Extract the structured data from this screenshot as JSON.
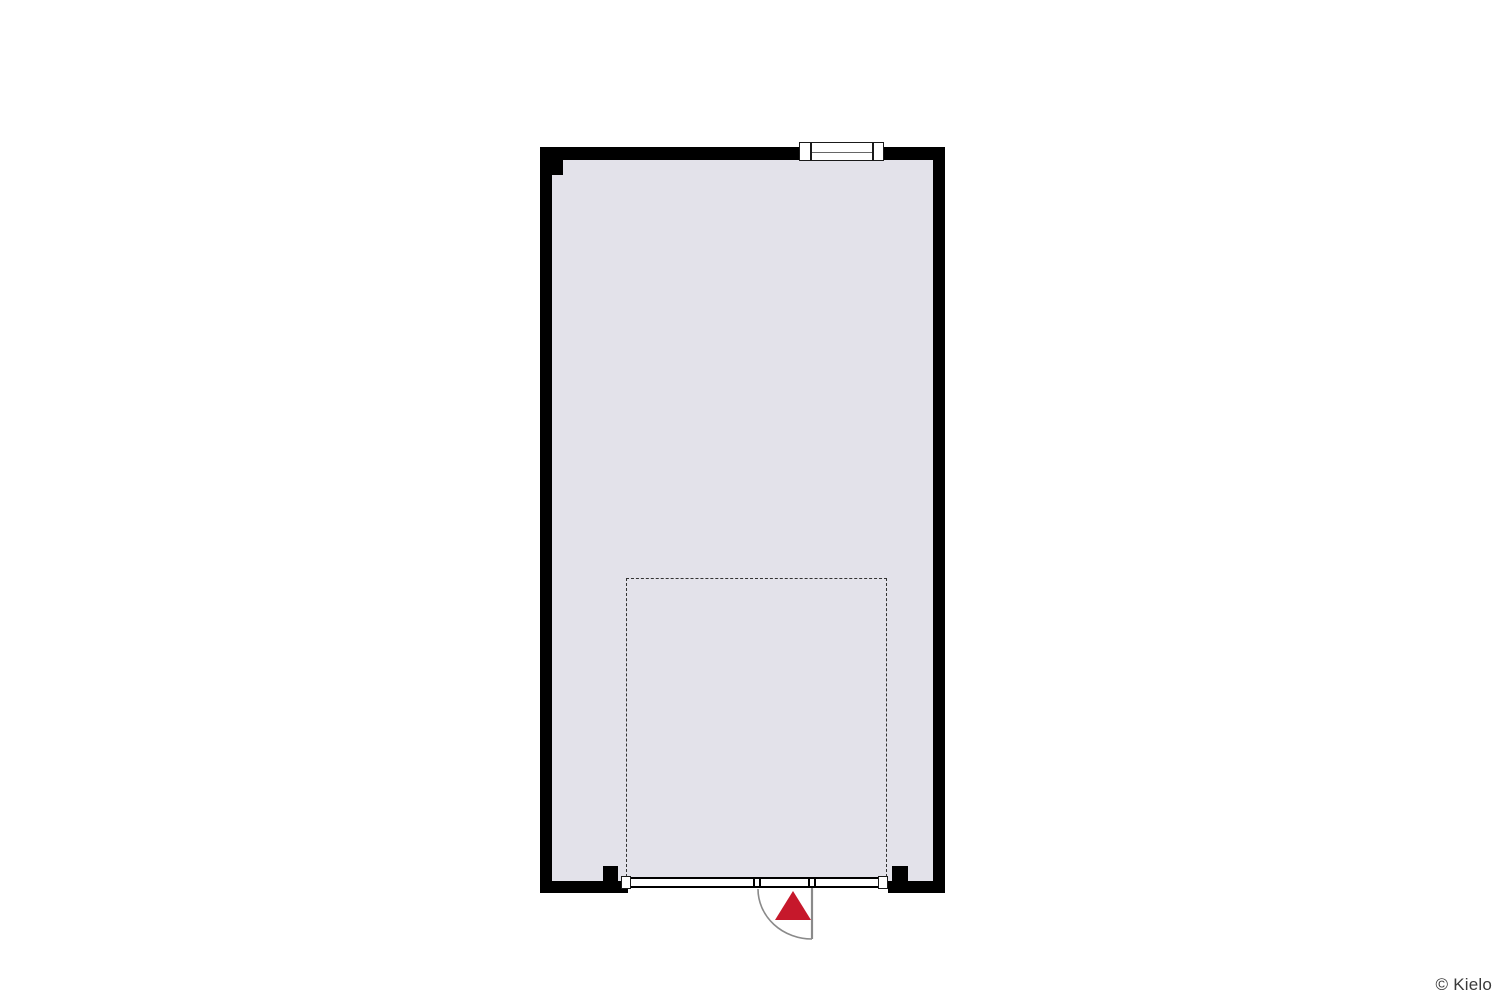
{
  "colors": {
    "background": "#ffffff",
    "wall": "#000000",
    "floor": "#e3e2ea",
    "frame": "#1a1a1a",
    "glazing": "#ffffff",
    "swing": "#8a8a8a",
    "marker": "#c6182b",
    "outline": "#333333",
    "text": "#3a3a3a"
  },
  "plan": {
    "type": "floor-plan",
    "room": "open-space",
    "icons": {
      "window": "window-icon",
      "glazed_wall": "window-wall-icon",
      "door": "door-swing-icon",
      "entrance": "entrance-arrow-icon",
      "highlight": "dashed-area-outline"
    }
  },
  "footer": {
    "copyright": "© Kielo"
  }
}
